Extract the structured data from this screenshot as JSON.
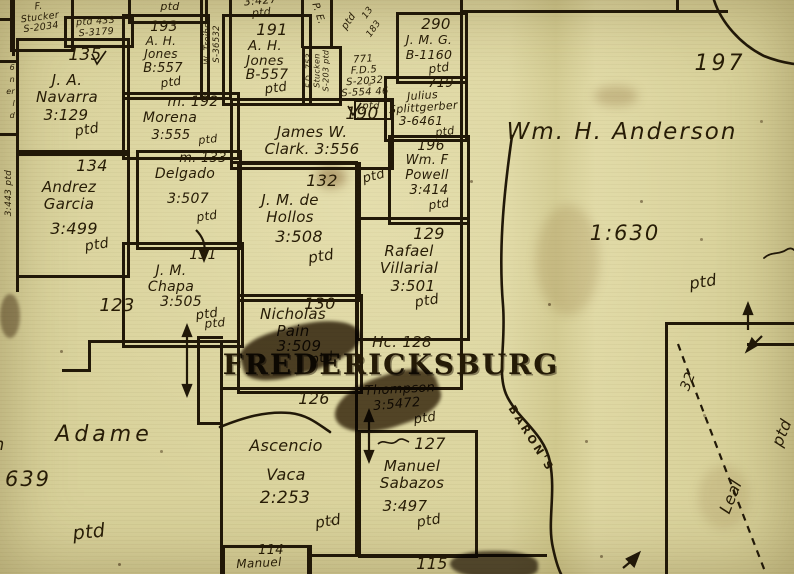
{
  "map": {
    "town": "FREDERICKSBURG",
    "creek": "BARON'S",
    "surveys": {
      "navarra": {
        "no": "135",
        "name": "J. A.\nNavarra",
        "ref": "3:129",
        "ptd": "ptd"
      },
      "jones_a": {
        "no": "193",
        "name": "A. H.\nJones",
        "ref": "B:557",
        "ptd": "ptd"
      },
      "jones_b": {
        "no": "191",
        "name": "A. H.\nJones",
        "ref": "B-557",
        "ptd": "ptd"
      },
      "morena": {
        "no": "m. 192",
        "name": "Morena",
        "ref": "3:555",
        "ptd": "ptd"
      },
      "delgado": {
        "no": "m. 133",
        "name": "Delgado",
        "ref": "3:507",
        "ptd": "ptd"
      },
      "garcia": {
        "no": "134",
        "name": "Andrez\nGarcia",
        "ref": "3:499",
        "ptd": "ptd"
      },
      "chapa": {
        "no": "131",
        "name": "J. M.\nChapa",
        "ref": "3:505",
        "ptd": "ptd"
      },
      "clark": {
        "no": "190",
        "name": "James W.\nClark. 3:556",
        "ptd": "ptd"
      },
      "hollos": {
        "no": "132",
        "name": "J. M. de\nHollos",
        "ref": "3:508",
        "ptd": "ptd"
      },
      "pain": {
        "no": "130",
        "name": "Nicholas\nPain",
        "ref": "3:509",
        "ptd": "ptd"
      },
      "jmg": {
        "no": "290",
        "name": "J. M. G.",
        "ref": "B-1160",
        "ptd": "ptd"
      },
      "splittgerber": {
        "no": "719",
        "name": "Julius\nSplittgerber",
        "ref": "3-6461",
        "ptd": "ptd"
      },
      "powell": {
        "no": "196",
        "name": "Wm. F\nPowell",
        "ref": "3:414",
        "ptd": "ptd"
      },
      "villarial": {
        "no": "129",
        "name": "Rafael\nVillarial",
        "ref": "3:501",
        "ptd": "ptd"
      },
      "hc128": {
        "no": "Hc. 128"
      },
      "thompson": {
        "no": "126",
        "name": "Thompson",
        "ref": "3:5472",
        "ptd": "ptd"
      },
      "sabazos": {
        "no": "127",
        "name": "Manuel\nSabazos",
        "ref": "3:497",
        "ptd": "ptd"
      },
      "vaca": {
        "name": "Ascencio\nVaca",
        "ref": "2:253",
        "ptd": "ptd"
      },
      "anderson": {
        "no": "197",
        "name": "Wm. H. Anderson",
        "ref": "1:630",
        "ptd": "ptd"
      },
      "adame": {
        "name": "Adame",
        "ref": "639",
        "ptd": "ptd"
      },
      "p123": {
        "no": "123"
      },
      "p114": {
        "no": "114",
        "name": "Manuel"
      },
      "p115": {
        "no": "115"
      },
      "leal": {
        "no": "32",
        "name": "Leal",
        "ptd": "ptd"
      },
      "stucker": {
        "name": "F.\nStucker\nS-2034",
        "ptd": "ptd"
      },
      "stucken": {
        "name": "F.D. 753\nStucken\nS-203 ptd"
      },
      "treibs": {
        "name": "W. Treibs\nS-36532"
      },
      "fd5": {
        "no": "771",
        "name": "F.D.5\nS-2032",
        "ref": "S-554 46",
        "ptd": "ptd"
      }
    },
    "fragments": {
      "ptd433": "ptd 433\nS-3179",
      "p427": "3:427\nptd",
      "top_ptd": "ptd",
      "pe": "P. E.",
      "diag_ptd": "ptd",
      "diag13": "13",
      "diag183": "183",
      "edge443": "3:443 ptd",
      "edge_letters": "6\nn\ner\nl\nd",
      "left_ptd": "ptd",
      "adame_pre": "n"
    }
  }
}
